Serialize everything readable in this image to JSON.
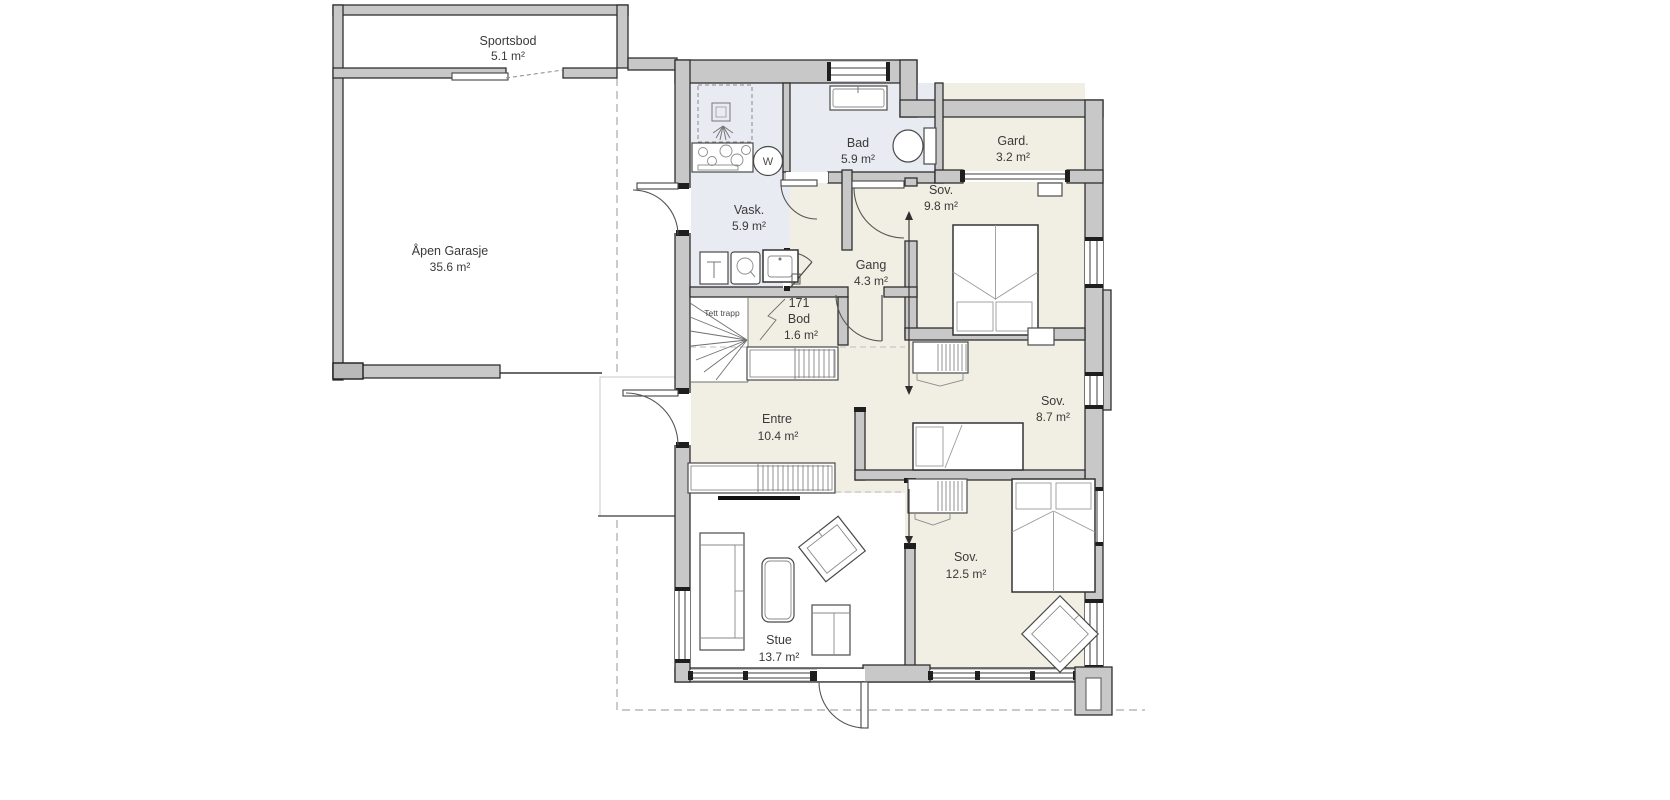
{
  "canvas": {
    "width": 1670,
    "height": 800,
    "background": "#ffffff"
  },
  "colors": {
    "wall_fill": "#c8c8c8",
    "wall_edge": "#2f2f2f",
    "floor_cream": "#f1eee4",
    "floor_wet": "#e9ebf2",
    "floor_white": "#ffffff",
    "overhang_dash": "#a9a9a9",
    "label_text": "#3a3a3a"
  },
  "rooms": [
    {
      "id": "sportsbod",
      "name": "Sportsbod",
      "area": "5.1 m²"
    },
    {
      "id": "garage",
      "name": "Åpen Garasje",
      "area": "35.6 m²"
    },
    {
      "id": "bad",
      "name": "Bad",
      "area": "5.9 m²"
    },
    {
      "id": "gard",
      "name": "Gard.",
      "area": "3.2 m²"
    },
    {
      "id": "vask",
      "name": "Vask.",
      "area": "5.9 m²"
    },
    {
      "id": "sov-nord",
      "name": "Sov.",
      "area": "9.8 m²"
    },
    {
      "id": "gang",
      "name": "Gang",
      "area": "4.3 m²"
    },
    {
      "id": "bod",
      "number": "171",
      "name": "Bod",
      "area": "1.6 m²"
    },
    {
      "id": "trapp",
      "name": "Tett trapp"
    },
    {
      "id": "entre",
      "name": "Entre",
      "area": "10.4 m²"
    },
    {
      "id": "sov-midt",
      "name": "Sov.",
      "area": "8.7 m²"
    },
    {
      "id": "sov-sor",
      "name": "Sov.",
      "area": "12.5 m²"
    },
    {
      "id": "stue",
      "name": "Stue",
      "area": "13.7 m²"
    }
  ],
  "symbols": {
    "washing_machine": "W"
  }
}
